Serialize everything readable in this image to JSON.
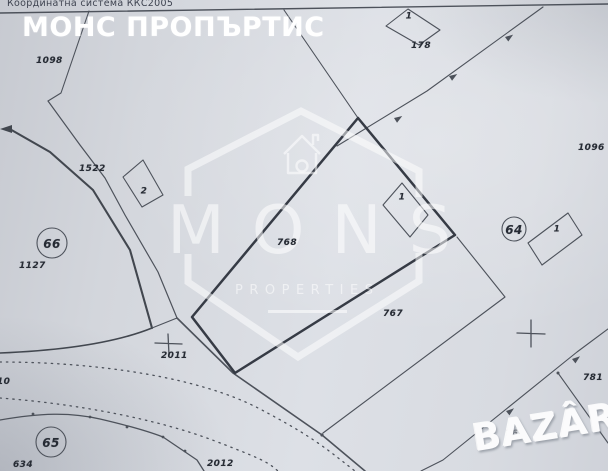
{
  "header": {
    "coordinate_system": "Координатна система ККС2005",
    "title": "МОНС ПРОПЪРТИС"
  },
  "watermark": {
    "brand": "MONS",
    "brand_sub": "PROPERTIES",
    "bazar": "BAZÂR"
  },
  "map": {
    "labels": [
      {
        "text": "1098"
      },
      {
        "text": "1522"
      },
      {
        "text": "2"
      },
      {
        "text": "66"
      },
      {
        "text": "1127"
      },
      {
        "text": "768"
      },
      {
        "text": "1"
      },
      {
        "text": "178"
      },
      {
        "text": "1"
      },
      {
        "text": "1096"
      },
      {
        "text": "64"
      },
      {
        "text": "1"
      },
      {
        "text": "2011"
      },
      {
        "text": "65"
      },
      {
        "text": "634"
      },
      {
        "text": "2012"
      },
      {
        "text": "10"
      },
      {
        "text": "767"
      },
      {
        "text": "781"
      },
      {
        "text": "762"
      }
    ]
  },
  "colors": {
    "paper": "#d7dae0",
    "thin_line": "#4d525b",
    "parcel_outline": "#363b45",
    "label_text": "#262b34",
    "watermark_white": "#ffffff"
  }
}
